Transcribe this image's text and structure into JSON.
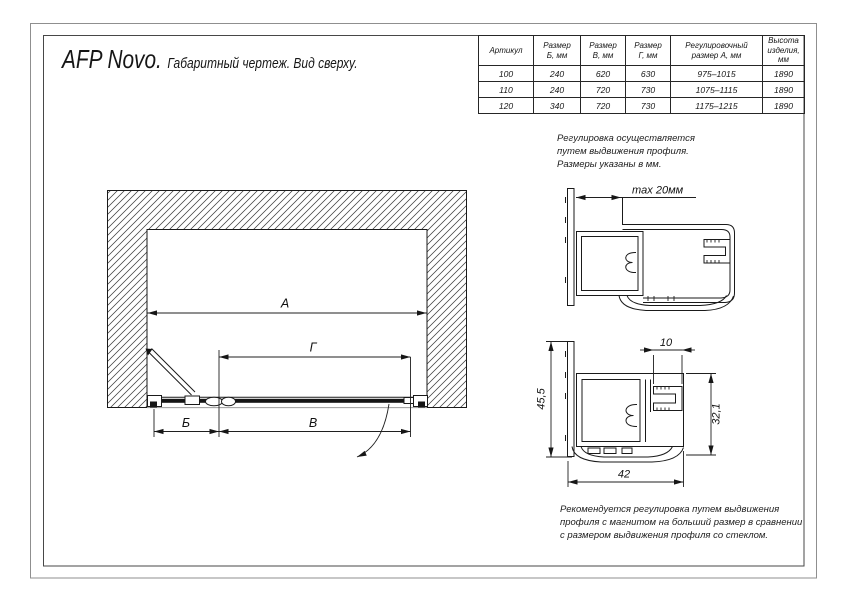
{
  "title": {
    "product": "AFP Novo.",
    "description": "Габаритный чертеж. Вид сверху."
  },
  "table": {
    "headers": [
      [
        "Артикул"
      ],
      [
        "Размер",
        "Б, мм"
      ],
      [
        "Размер",
        "В, мм"
      ],
      [
        "Размер",
        "Г, мм"
      ],
      [
        "Регулировочный",
        "размер А, мм"
      ],
      [
        "Высота",
        "изделия,",
        "мм"
      ]
    ],
    "rows": [
      [
        "100",
        "240",
        "620",
        "630",
        "975–1015",
        "1890"
      ],
      [
        "110",
        "240",
        "720",
        "730",
        "1075–1115",
        "1890"
      ],
      [
        "120",
        "340",
        "720",
        "730",
        "1175–1215",
        "1890"
      ]
    ]
  },
  "notes": {
    "adjustment": [
      "Регулировка осуществляется",
      "путем выдвижения профиля.",
      "Размеры указаны в мм."
    ],
    "recommendation": [
      "Рекомендуется регулировка путем выдвижения",
      "профиля с магнитом на больший размер в сравнении",
      "с размером выдвижения профиля со стеклом."
    ]
  },
  "plan_view": {
    "dim_a": "A",
    "dim_g": "Г",
    "dim_b": "Б",
    "dim_v": "В"
  },
  "profile_details": {
    "max_extension": "max 20мм",
    "height": "45,5",
    "glass_slot": "10",
    "inner_height": "32,1",
    "width": "42"
  },
  "colors": {
    "line": "#1a1a1a",
    "frame_outer": "#8f8f8f",
    "frame_inner": "#474747",
    "niche_opening_line": "#9c9c9c",
    "background": "#ffffff"
  }
}
